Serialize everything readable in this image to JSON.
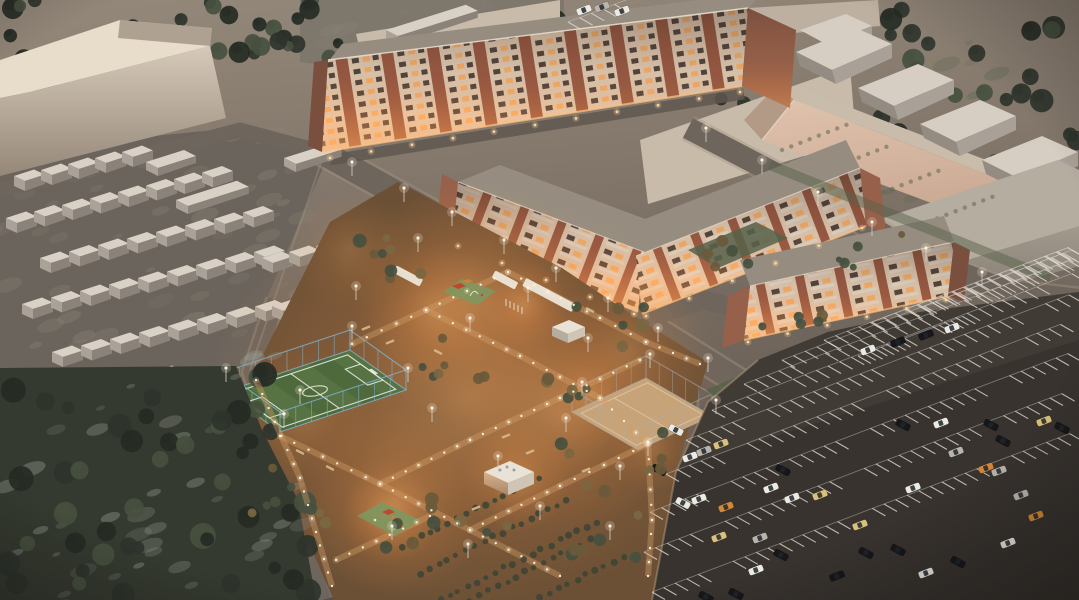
{
  "meta": {
    "title": "Aerial dusk rendering of a residential complex",
    "description": "3D architectural visualization at dusk: long brick apartment buildings with glowing windows, rows of garages, a warm-lit courtyard with playgrounds and pavilions, a fenced soccer field, a sand sports court, dark woods and a large striped parking lot with parked cars"
  },
  "palette": {
    "ground1": "#94887a",
    "ground2": "#83776b",
    "ground3": "#6e645a",
    "ground4": "#57504a",
    "garageGround": "#6b645c",
    "topStrip": "#7e776c",
    "road": "#6e655c",
    "roadEdge": "#a2937f",
    "roadDark": "#5f574f",
    "curbLine": "#b39a7c",
    "parking1": "#4a443e",
    "parking2": "#38332f",
    "stripeWhite": "#dedad1",
    "facadeCream": "#e8d2ba",
    "facadeBrick": "#9c5a44",
    "brickDark": "#7a4f3e",
    "brickEnd": "#96604a",
    "windowDark": "#4f443d",
    "windowLit": "#ffb56d",
    "balconyWhite": "#e9e0d1",
    "roofGray": "#968d80",
    "roofDark": "#8a8174",
    "roofLight": "#e8dccb",
    "massingLight": "#d6c9ba",
    "massingDark": "#958878",
    "massingTan": "#c9bbaa",
    "massingTan2": "#bdb0a0",
    "pinkTop": "#e0c3ad",
    "pinkBottom": "#c4a28c",
    "pinkRoof": "#cabcab",
    "pinkSide": "#b39a86",
    "warehouseRoof": "#d6cec2",
    "warehouseFront": "#a9a198",
    "warehouseSide": "#948c82",
    "grayTop": "#b6ada1",
    "grayFront1": "#a39a8e",
    "grayFront2": "#7f776d",
    "garageTop": "#d9d1c5",
    "garageFront": "#aaa298",
    "garageSide": "#8b837a",
    "treeDark": "#2e342c",
    "treeMid": "#47503f",
    "treeDeep": "#252b24",
    "treeWarm": "#6a5a3b",
    "treeWarm2": "#7a6742",
    "woodsGround": "#353a30",
    "mottleLight": "#8a8377",
    "mottleSnow": "#979d94",
    "mottleLawn": "#5f6852",
    "fieldGreen": "#4e6a3c",
    "fieldLight": "#5f7a49",
    "lineWhite": "#e8ecdf",
    "fenceBlue": "#85b8da",
    "fencePost": "#a8b0b4",
    "courtSand": "#c7a379",
    "courtLine": "#e4d0ae",
    "courtyard1": "#8a6644",
    "courtyard2": "#6b5036",
    "pathLight": "#d29e66",
    "glowOrange": "#ffb46a",
    "lightDot": "#fff3dd",
    "warmDot": "#ffd9a0",
    "lawnGreen": "#57614a",
    "hedgeGreen": "#3f4535",
    "canopyWhite": "#efe9dd",
    "pavTop": "#e9e2d6",
    "pavFront": "#b7ad9f",
    "pavSide": "#cfc5b6",
    "pavLitA": "#d9b089",
    "pavLitB": "#a8876a",
    "playRed": "#c2452e",
    "playGreen": "#87996a",
    "playOrange": "#d07f3a",
    "playMat": "#7f975f",
    "carWhite": "#eceae3",
    "carBlack": "#17171a",
    "carSilver": "#b9b5ac",
    "carTan": "#d9c07c",
    "carOrange": "#d2883a",
    "benchTan": "#d7b98c"
  },
  "scene": {
    "garages": {
      "rows": [
        [
          14,
          176,
          5,
          27,
          -6
        ],
        [
          6,
          218,
          8,
          28,
          -6.5
        ],
        [
          40,
          258,
          8,
          29,
          -6.5
        ],
        [
          22,
          304,
          9,
          29,
          -6.5
        ],
        [
          52,
          352,
          8,
          29,
          -6.5
        ],
        [
          36,
          398,
          5,
          29,
          -6.5
        ],
        [
          262,
          258,
          4,
          27,
          -6
        ],
        [
          272,
          306,
          4,
          27,
          -6
        ],
        [
          286,
          352,
          4,
          27,
          -6
        ]
      ],
      "sheds": [
        [
          146,
          162,
          40
        ],
        [
          176,
          200,
          64
        ],
        [
          284,
          158,
          48
        ],
        [
          386,
          30,
          84
        ]
      ]
    },
    "trees": {
      "clusters": [
        [
          0,
          0,
          340,
          62,
          30,
          5,
          11,
          "dark"
        ],
        [
          0,
          52,
          62,
          90,
          8,
          5,
          9,
          "dark"
        ],
        [
          556,
          0,
          238,
          50,
          16,
          5,
          10,
          "dark"
        ],
        [
          880,
          0,
          198,
          146,
          30,
          6,
          12,
          "dark"
        ],
        [
          992,
          148,
          86,
          66,
          8,
          5,
          9,
          "dark"
        ],
        [
          688,
          58,
          80,
          50,
          7,
          4,
          7,
          "dark"
        ],
        [
          356,
          238,
          128,
          58,
          8,
          4,
          7,
          "warm"
        ],
        [
          252,
          452,
          118,
          78,
          8,
          4,
          7,
          "warm"
        ],
        [
          412,
          322,
          56,
          56,
          5,
          4,
          7,
          "warm"
        ],
        [
          478,
          372,
          118,
          88,
          10,
          4,
          7,
          "warm"
        ],
        [
          560,
          300,
          88,
          58,
          6,
          4,
          7,
          "warm"
        ],
        [
          370,
          482,
          138,
          66,
          9,
          4,
          7,
          "warm"
        ],
        [
          562,
          470,
          88,
          88,
          8,
          4,
          7,
          "warm"
        ],
        [
          622,
          430,
          56,
          56,
          5,
          4,
          7,
          "warm"
        ],
        [
          756,
          300,
          72,
          40,
          5,
          4,
          6,
          "mid"
        ],
        [
          700,
          236,
          70,
          40,
          5,
          4,
          6,
          "mid"
        ],
        [
          830,
          232,
          80,
          38,
          5,
          3,
          6,
          "mid"
        ]
      ],
      "woods_cluster": [
        0,
        372,
        312,
        224,
        46,
        6,
        13,
        "woods"
      ]
    },
    "mottle": {
      "clusters": [
        [
          0,
          150,
          320,
          215,
          55,
          "mottleLight"
        ],
        [
          300,
          0,
          250,
          60,
          18,
          "mottleLight"
        ],
        [
          780,
          60,
          290,
          190,
          22,
          "mottleLawn"
        ]
      ],
      "woods": [
        0,
        380,
        310,
        215,
        40,
        "mottleSnow"
      ]
    },
    "field": {
      "quad": [
        [
          224,
          392
        ],
        [
          350,
          350
        ],
        [
          406,
          390
        ],
        [
          280,
          432
        ]
      ],
      "fence_h": 20
    },
    "court": {
      "quad": [
        [
          572,
          412
        ],
        [
          646,
          378
        ],
        [
          712,
          416
        ],
        [
          638,
          450
        ]
      ],
      "fence_h": 22
    },
    "parking": {
      "stripe_rows": [
        [
          652,
          592,
          36
        ],
        [
          644,
          552,
          36
        ],
        [
          650,
          512,
          36
        ],
        [
          666,
          474,
          34
        ],
        [
          686,
          440,
          33
        ],
        [
          712,
          410,
          31
        ],
        [
          744,
          384,
          28
        ],
        [
          782,
          360,
          25
        ],
        [
          824,
          340,
          21
        ],
        [
          872,
          322,
          17
        ],
        [
          924,
          306,
          12
        ],
        [
          980,
          294,
          8
        ],
        [
          568,
          22,
          6
        ],
        [
          858,
          356,
          9
        ]
      ],
      "cars": [
        [
          659,
          470,
          28,
          "carBlack"
        ],
        [
          690,
          457,
          -21,
          "carWhite"
        ],
        [
          704,
          451,
          -21,
          "carSilver"
        ],
        [
          721,
          444,
          -21,
          "carTan"
        ],
        [
          683,
          503,
          28,
          "carWhite"
        ],
        [
          699,
          499,
          -21,
          "carWhite"
        ],
        [
          726,
          507,
          -21,
          "carOrange"
        ],
        [
          719,
          537,
          -21,
          "carTan"
        ],
        [
          760,
          538,
          -21,
          "carSilver"
        ],
        [
          781,
          555,
          28,
          "carBlack"
        ],
        [
          756,
          570,
          -21,
          "carWhite"
        ],
        [
          783,
          470,
          28,
          "carBlack"
        ],
        [
          771,
          488,
          -21,
          "carWhite"
        ],
        [
          792,
          498,
          -21,
          "carWhite"
        ],
        [
          820,
          495,
          -21,
          "carTan"
        ],
        [
          860,
          525,
          -21,
          "carTan"
        ],
        [
          866,
          553,
          28,
          "carBlack"
        ],
        [
          898,
          550,
          28,
          "carBlack"
        ],
        [
          837,
          576,
          -21,
          "carBlack"
        ],
        [
          926,
          573,
          -21,
          "carWhite"
        ],
        [
          903,
          425,
          28,
          "carBlack"
        ],
        [
          941,
          423,
          -21,
          "carWhite"
        ],
        [
          991,
          425,
          28,
          "carBlack"
        ],
        [
          1003,
          441,
          28,
          "carBlack"
        ],
        [
          986,
          468,
          -21,
          "carOrange"
        ],
        [
          999,
          471,
          -21,
          "carSilver"
        ],
        [
          1021,
          495,
          -21,
          "carSilver"
        ],
        [
          1036,
          516,
          -21,
          "carOrange"
        ],
        [
          1062,
          428,
          28,
          "carBlack"
        ],
        [
          1044,
          421,
          -21,
          "carTan"
        ],
        [
          706,
          597,
          28,
          "carBlack"
        ],
        [
          736,
          594,
          28,
          "carBlack"
        ],
        [
          868,
          350,
          -21,
          "carWhite"
        ],
        [
          898,
          342,
          -21,
          "carBlack"
        ],
        [
          926,
          335,
          -21,
          "carBlack"
        ],
        [
          952,
          328,
          -21,
          "carWhite"
        ],
        [
          584,
          10,
          -21,
          "carWhite"
        ],
        [
          602,
          7,
          -21,
          "carSilver"
        ],
        [
          622,
          11,
          -21,
          "carWhite"
        ],
        [
          676,
          430,
          28,
          "carWhite"
        ],
        [
          913,
          488,
          -21,
          "carWhite"
        ],
        [
          956,
          452,
          -21,
          "carSilver"
        ],
        [
          1008,
          543,
          -21,
          "carWhite"
        ],
        [
          958,
          562,
          28,
          "carBlack"
        ]
      ]
    },
    "lamps": [
      [
        352,
        176
      ],
      [
        404,
        202
      ],
      [
        452,
        226
      ],
      [
        504,
        254
      ],
      [
        556,
        282
      ],
      [
        608,
        312
      ],
      [
        658,
        342
      ],
      [
        708,
        372
      ],
      [
        706,
        142
      ],
      [
        762,
        174
      ],
      [
        818,
        206
      ],
      [
        872,
        236
      ],
      [
        926,
        262
      ],
      [
        982,
        286
      ],
      [
        300,
        404
      ],
      [
        356,
        300
      ],
      [
        418,
        252
      ],
      [
        470,
        332
      ],
      [
        528,
        302
      ],
      [
        588,
        352
      ],
      [
        432,
        422
      ],
      [
        498,
        470
      ],
      [
        566,
        432
      ],
      [
        620,
        480
      ],
      [
        392,
        540
      ],
      [
        468,
        558
      ],
      [
        540,
        520
      ],
      [
        610,
        540
      ],
      [
        226,
        382
      ],
      [
        352,
        340
      ],
      [
        408,
        382
      ],
      [
        284,
        428
      ],
      [
        582,
        396
      ],
      [
        650,
        368
      ],
      [
        716,
        414
      ],
      [
        648,
        456
      ]
    ],
    "glow_lines": [
      [
        [
          330,
          158
        ],
        [
          740,
          92
        ]
      ],
      [
        [
          458,
          246
        ],
        [
          634,
          314
        ]
      ],
      [
        [
          646,
          316
        ],
        [
          862,
          228
        ]
      ],
      [
        [
          748,
          342
        ],
        [
          946,
          300
        ]
      ]
    ],
    "light_paths": [
      [
        [
          352,
          344
        ],
        [
          426,
          310
        ],
        [
          508,
          272
        ]
      ],
      [
        [
          426,
          310
        ],
        [
          520,
          356
        ],
        [
          600,
          398
        ]
      ],
      [
        [
          508,
          272
        ],
        [
          600,
          318
        ],
        [
          646,
          342
        ]
      ],
      [
        [
          280,
          436
        ],
        [
          380,
          484
        ],
        [
          470,
          530
        ],
        [
          560,
          576
        ]
      ],
      [
        [
          380,
          484
        ],
        [
          470,
          440
        ],
        [
          560,
          398
        ],
        [
          640,
          360
        ]
      ],
      [
        [
          470,
          530
        ],
        [
          560,
          486
        ],
        [
          648,
          444
        ]
      ],
      [
        [
          336,
          560
        ],
        [
          430,
          516
        ]
      ],
      [
        [
          600,
          398
        ],
        [
          648,
          444
        ]
      ],
      [
        [
          648,
          444
        ],
        [
          652,
          520
        ],
        [
          648,
          576
        ]
      ],
      [
        [
          256,
          380
        ],
        [
          300,
          478
        ],
        [
          332,
          586
        ]
      ],
      [
        [
          646,
          342
        ],
        [
          700,
          364
        ]
      ]
    ],
    "glows": [
      [
        472,
        300,
        120,
        0.45
      ],
      [
        560,
        412,
        120,
        0.4
      ],
      [
        396,
        502,
        95,
        0.45
      ],
      [
        628,
        352,
        80,
        0.3
      ],
      [
        300,
        416,
        70,
        0.3
      ],
      [
        524,
        304,
        44,
        0.5
      ],
      [
        390,
        516,
        48,
        0.5
      ],
      [
        516,
        478,
        55,
        0.45
      ],
      [
        592,
        396,
        55,
        0.35
      ],
      [
        652,
        448,
        45,
        0.3
      ],
      [
        350,
        250,
        60,
        0.25
      ],
      [
        436,
        312,
        70,
        0.4
      ]
    ],
    "hedges": {
      "rows": [
        [
          402,
          546,
          16
        ],
        [
          420,
          574,
          17
        ],
        [
          440,
          600,
          18
        ],
        [
          470,
          600,
          14
        ],
        [
          540,
          598,
          10
        ]
      ],
      "lawn_rows": [
        [
          782,
          150,
          8
        ],
        [
          822,
          172,
          8
        ],
        [
          874,
          196,
          8
        ],
        [
          928,
          222,
          8
        ]
      ]
    },
    "benches": [
      [
        366,
        328,
        -21
      ],
      [
        390,
        342,
        -21
      ],
      [
        300,
        452,
        28
      ],
      [
        330,
        468,
        28
      ],
      [
        506,
        436,
        -21
      ],
      [
        530,
        452,
        -21
      ],
      [
        586,
        470,
        -21
      ],
      [
        438,
        352,
        28
      ],
      [
        476,
        508,
        -21
      ],
      [
        590,
        310,
        28
      ]
    ]
  }
}
